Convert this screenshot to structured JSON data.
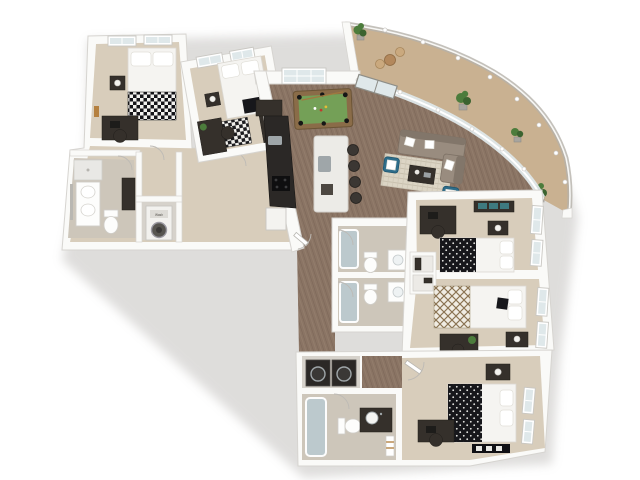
{
  "meta": {
    "image_type": "3d-floor-plan-dollhouse-render",
    "view": "top-down axonometric",
    "background": "white"
  },
  "labels": {
    "washer": "Wash"
  },
  "colors": {
    "bg": "#ffffff",
    "wall": "#fafaf8",
    "wallShade": "#d6d4d0",
    "wallDark": "#bdbab5",
    "carpet": "#d8cdbb",
    "bathFloor": "#cdc6ba",
    "wood": "#8a7464",
    "woodDark": "#6f5a4b",
    "woodLight": "#a08a77",
    "balconyFloor": "#c9b191",
    "glassPane": "#dfe8ea",
    "railGlass": "#b5b2aa",
    "felt": "#74a057",
    "tableFrame": "#8a6c48",
    "sofa": "#998c7f",
    "sofaDark": "#82766a",
    "rug": "#dcd5c5",
    "accentChair": "#2e6d8a",
    "darkWood": "#35302b",
    "blackFabric": "#17171b",
    "whiteFabric": "#f5f4f1",
    "tub": "#bcc9cd",
    "steel": "#9fa6a9",
    "plant": "#4c7c3c",
    "plantDark": "#3b6330",
    "island": "#ecebe7",
    "counterDark": "#2b2826",
    "artAccent": "#b5803f",
    "screenTeal": "#3e7a80",
    "doormat": "#101014"
  },
  "scene": {
    "bedrooms": 5,
    "bathrooms": 4,
    "rooms": [
      {
        "name": "bedroom-1",
        "furniture": [
          "bed with checkered throw",
          "nightstand with lamp",
          "desk with chair",
          "wall art"
        ]
      },
      {
        "name": "bedroom-2",
        "furniture": [
          "bed",
          "nightstand with lamp",
          "checkered rug",
          "desk with plant",
          "dresser"
        ]
      },
      {
        "name": "bathroom-1",
        "furniture": [
          "vanity with double sink",
          "toilet",
          "shower"
        ]
      },
      {
        "name": "laundry-closet",
        "furniture": [
          "stacked washer-dryer"
        ]
      },
      {
        "name": "great-room",
        "furniture": [
          "pool table",
          "sectional sofa",
          "area rug",
          "coffee table",
          "two accent chairs"
        ]
      },
      {
        "name": "kitchen",
        "furniture": [
          "counter run",
          "range",
          "sink",
          "refrigerator",
          "island with four bar stools"
        ]
      },
      {
        "name": "balcony",
        "furniture": [
          "bistro table",
          "two chairs",
          "potted plants",
          "curved glass railing"
        ]
      },
      {
        "name": "bedroom-3",
        "furniture": [
          "bed with polka-dot duvet",
          "media console",
          "desk with chair",
          "nightstand with lamp"
        ]
      },
      {
        "name": "bedroom-4",
        "furniture": [
          "bed with diamond-pattern blanket",
          "nightstand with lamp",
          "desk with plant",
          "closet shelving"
        ]
      },
      {
        "name": "bathroom-2",
        "furniture": [
          "bathtub",
          "toilet",
          "vanity"
        ]
      },
      {
        "name": "bathroom-3",
        "furniture": [
          "bathtub",
          "toilet",
          "vanity"
        ]
      },
      {
        "name": "laundry-2",
        "furniture": [
          "washer",
          "dryer"
        ]
      },
      {
        "name": "bathroom-4",
        "furniture": [
          "bathtub",
          "toilet",
          "dark vanity",
          "towel shelf"
        ]
      },
      {
        "name": "bedroom-5",
        "furniture": [
          "bed with polka-dot duvet",
          "nightstand with lamp",
          "desk with chair",
          "storage bench"
        ]
      }
    ]
  }
}
